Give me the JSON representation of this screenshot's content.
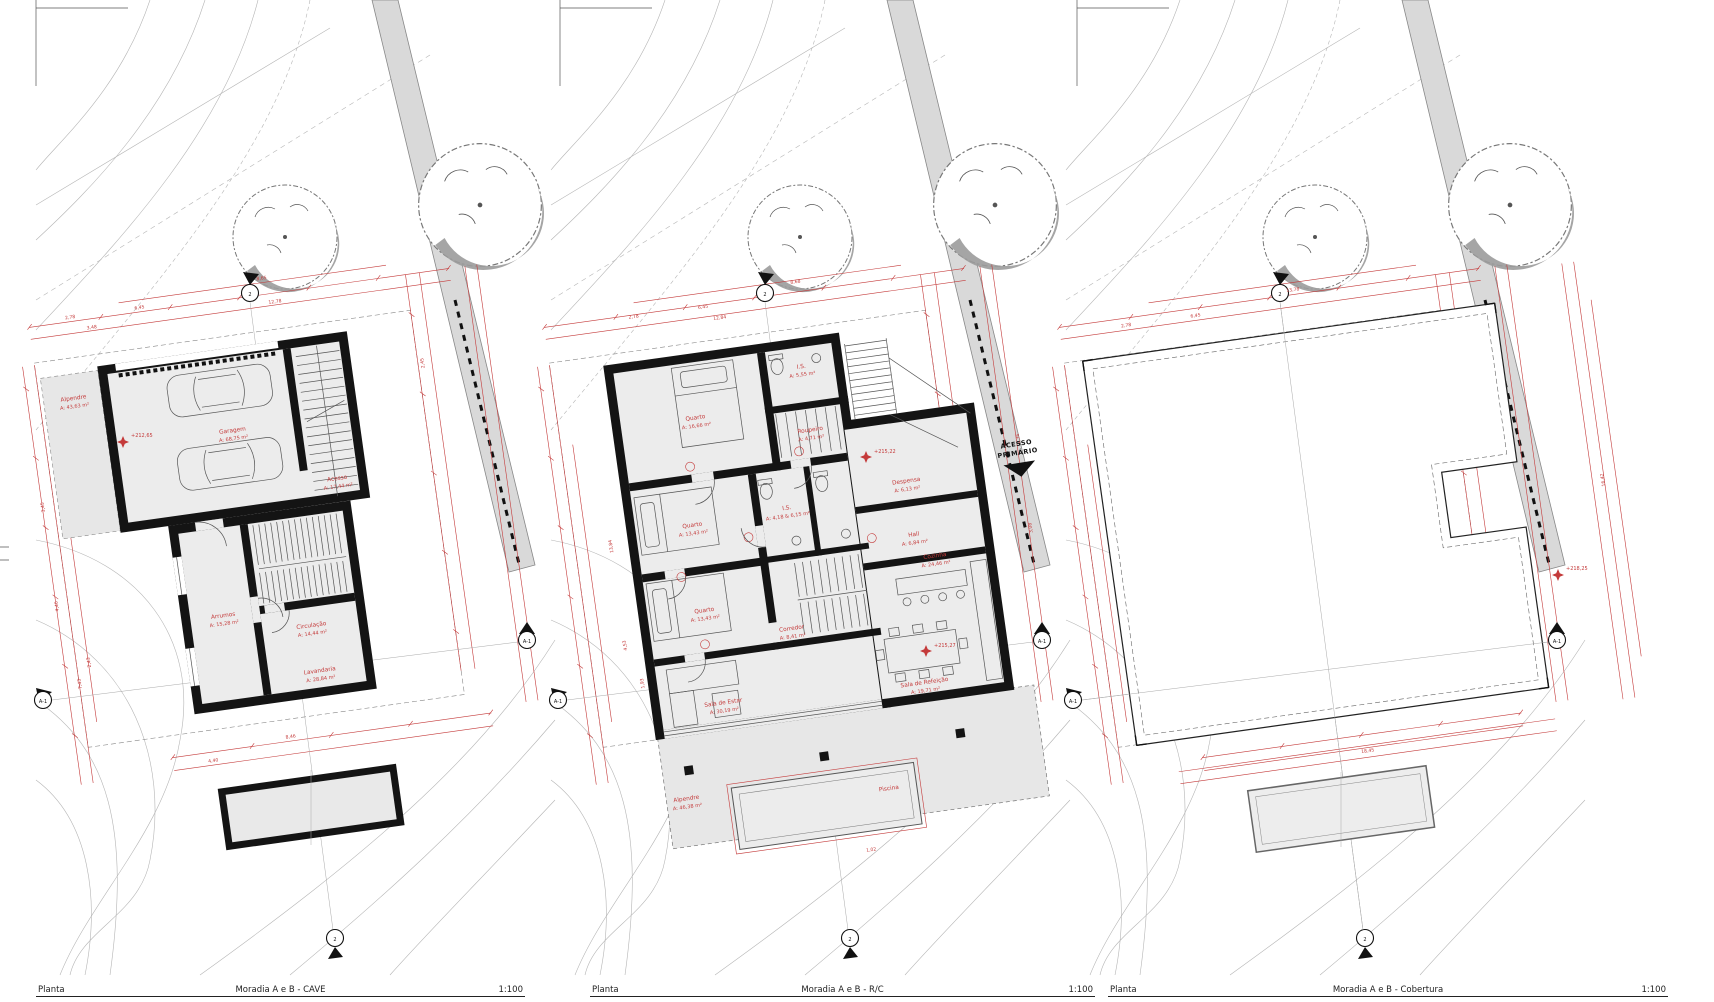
{
  "sheet": {
    "footers": [
      {
        "label": "Planta",
        "title": "Moradia A e B - CAVE",
        "scale": "1:100"
      },
      {
        "label": "Planta",
        "title": "Moradia A e B - R/C",
        "scale": "1:100"
      },
      {
        "label": "Planta",
        "title": "Moradia A e B - Cobertura",
        "scale": "1:100"
      }
    ],
    "markers": {
      "section_cut": "2",
      "section_long": "A-1"
    },
    "access": {
      "line1": "ACESSO",
      "line2": "PRIMÁRIO"
    },
    "panels": [
      {
        "name": "CAVE",
        "elevation": "+212,65",
        "rooms": [
          {
            "name": "Alpendre",
            "area": "A: 43,63 m²"
          },
          {
            "name": "Garagem",
            "area": "A: 68,75 m²"
          },
          {
            "name": "Acesso",
            "area": "A: 17,44 m²"
          },
          {
            "name": "Arrumos",
            "area": "A: 15,28 m²"
          },
          {
            "name": "Circulação",
            "area": "A: 14,44 m²"
          },
          {
            "name": "Lavandaria",
            "area": "A: 28,84 m²"
          }
        ],
        "dims": [
          "2,78",
          "6,45",
          "8,65",
          "3,48",
          "12,78",
          "3,45",
          "4,46",
          "7,43",
          "2,43",
          "2,45",
          "8,46",
          "4,40"
        ]
      },
      {
        "name": "R/C",
        "elevation_upper": "+215,22",
        "elevation_lower": "+215,27",
        "rooms": [
          {
            "name": "Quarto",
            "area": "A: 16,66 m²"
          },
          {
            "name": "I.S.",
            "area": "A: 5,55 m²"
          },
          {
            "name": "Roupeiro",
            "area": "A: 4,71 m²"
          },
          {
            "name": "Quarto",
            "area": "A: 13,43 m²"
          },
          {
            "name": "I.S.",
            "area": "A: 4,18 & 6,15 m²"
          },
          {
            "name": "Quarto",
            "area": "A: 13,43 m²"
          },
          {
            "name": "Corredor",
            "area": "A: 8,41 m²"
          },
          {
            "name": "Despensa",
            "area": "A: 6,13 m²"
          },
          {
            "name": "Hall",
            "area": "A: 6,84 m²"
          },
          {
            "name": "Cozinha",
            "area": "A: 24,46 m²"
          },
          {
            "name": "Sala de Estar",
            "area": "A: 30,19 m²"
          },
          {
            "name": "Sala de Refeição",
            "area": "A: 19,71 m²"
          },
          {
            "name": "Alpendre",
            "area": "A: 46,38 m²"
          },
          {
            "name": "Piscina",
            "area": ""
          }
        ],
        "dims": [
          "2,78",
          "6,45",
          "8,68",
          "12,84",
          "13,84",
          "4,53",
          "1,93",
          "2,36",
          "3,08",
          "1,02"
        ]
      },
      {
        "name": "Cobertura",
        "elevation": "+218,25",
        "rooms": [],
        "dims": [
          "2,78",
          "6,45",
          "13,78",
          "16,42",
          "18,45"
        ]
      }
    ]
  }
}
